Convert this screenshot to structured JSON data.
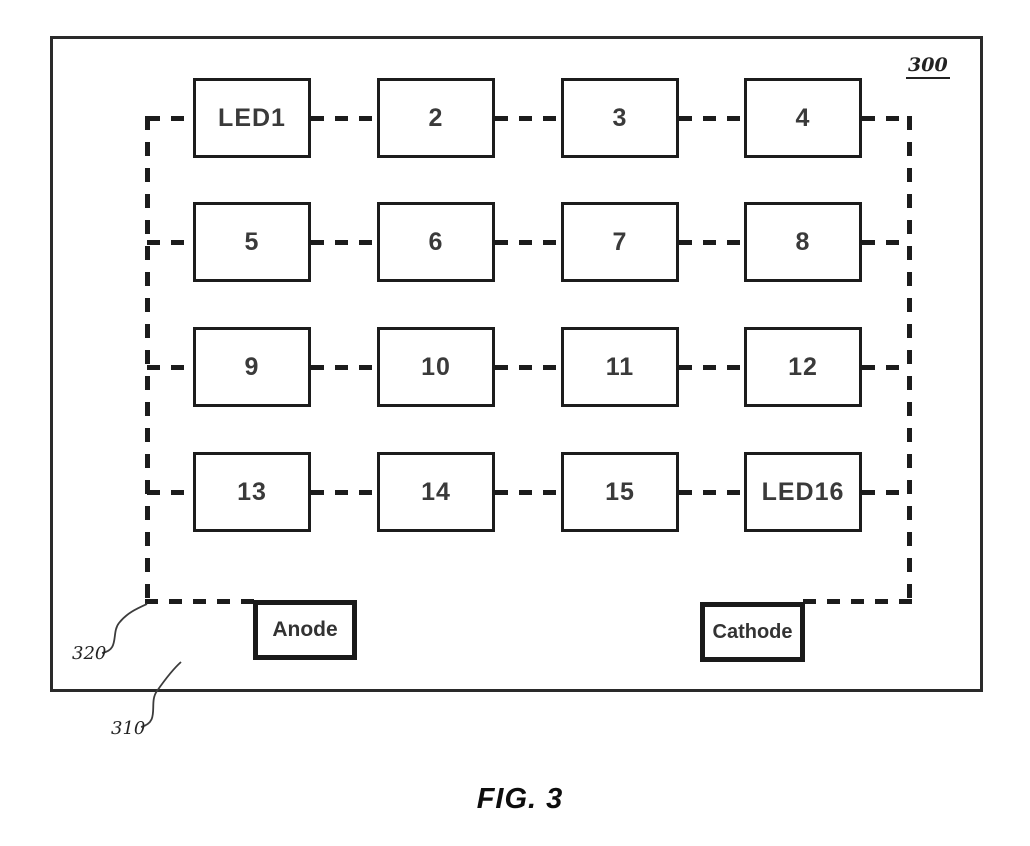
{
  "figure": {
    "reference_number": "300",
    "caption": "FIG. 3",
    "led_labels": [
      "LED1",
      "2",
      "3",
      "4",
      "5",
      "6",
      "7",
      "8",
      "9",
      "10",
      "11",
      "12",
      "13",
      "14",
      "15",
      "LED16"
    ],
    "anode_label": "Anode",
    "cathode_label": "Cathode",
    "callout_320": "320",
    "callout_310": "310"
  },
  "colors": {
    "line": "#1c1c1c",
    "label_text": "#3a3a3a",
    "background": "#ffffff"
  }
}
